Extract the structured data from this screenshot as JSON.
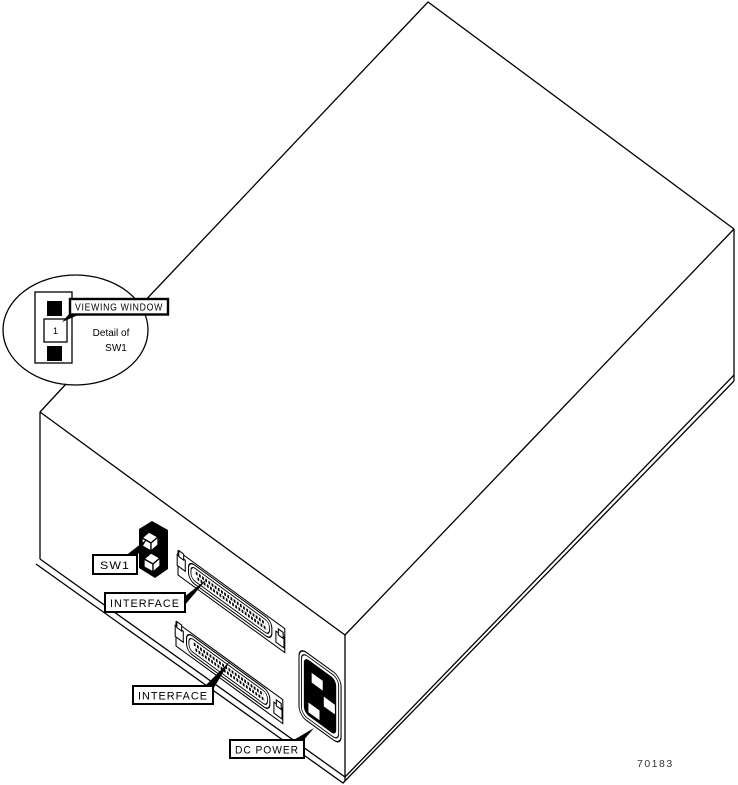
{
  "figure": {
    "number": "70183",
    "detail": {
      "callout": "VIEWING WINDOW",
      "caption_line1": "Detail of",
      "caption_line2": "SW1",
      "switch_position": "1"
    },
    "labels": {
      "sw1": "SW1",
      "interface_top": "INTERFACE",
      "interface_bottom": "INTERFACE",
      "dc_power": "DC POWER"
    },
    "colors": {
      "line": "#000000",
      "background": "#ffffff",
      "fig_number": "#333333"
    }
  }
}
